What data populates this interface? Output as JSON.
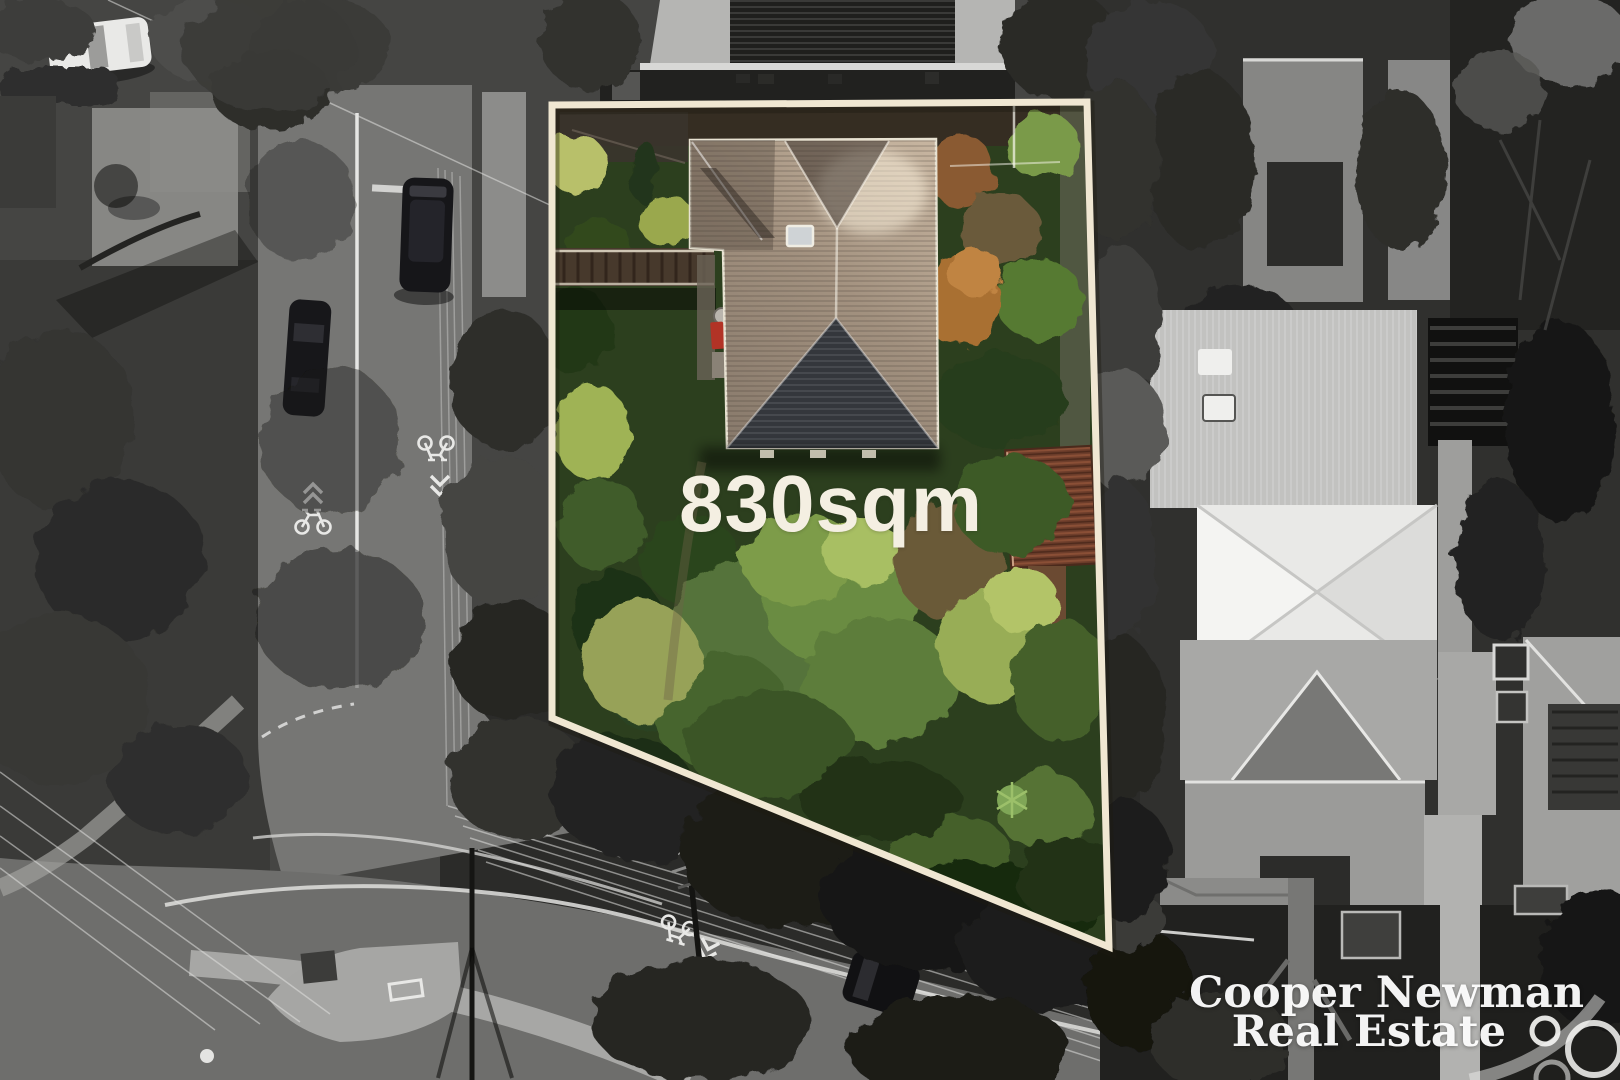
{
  "photo": {
    "kind": "aerial-drone-photo",
    "effect": "property lot shown in colour, surroundings in black-and-white",
    "boundary_color": "#f0e7d2",
    "label_color": "#f4efe2"
  },
  "property": {
    "area_label": "830sqm"
  },
  "watermark": {
    "line1": "Cooper Newman",
    "line2": "Real Estate",
    "color": "#ffffff",
    "mark": "double-ring-logo"
  }
}
